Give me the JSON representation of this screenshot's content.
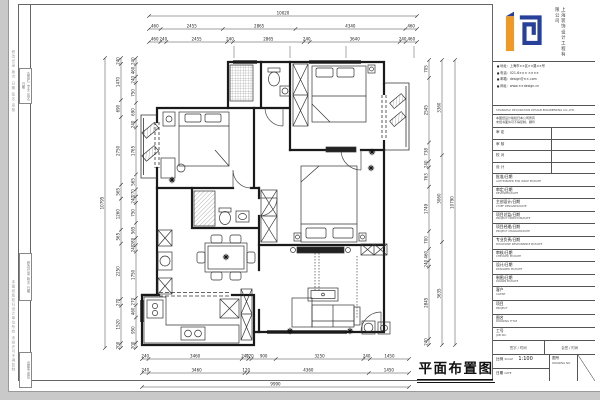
{
  "sheet": {
    "drawing_title": "平面布置图",
    "edge_note_top": "修改记录 版次 日期 签名 审核",
    "edge_note_bottom": "本图纸版权归设计单位所有 未经许可不得复制",
    "strip_boxes": [
      "会签栏 专业 签名 日期",
      "修改记录 版次 日期",
      "出图专用章"
    ]
  },
  "dims": {
    "top_overall": "10020",
    "top_row1": [
      "460",
      "2455",
      "2865",
      "4340",
      "460"
    ],
    "top_row2": [
      "460",
      "240",
      "2455",
      "240",
      "2865",
      "240",
      "3640",
      "240",
      "460"
    ],
    "bottom_row1": [
      "240",
      "3460",
      "240",
      "120",
      "900",
      "3250",
      "240",
      "1450"
    ],
    "bottom_row2": [
      "240",
      "3460",
      "120",
      "4360",
      "1450"
    ],
    "bottom_overall": "9990",
    "left_inner": [
      "240",
      "460",
      "240",
      "750",
      "690",
      "240",
      "1765",
      "565",
      "270",
      "240",
      "750",
      "565",
      "280",
      "240",
      "1750",
      "270",
      "460",
      "950",
      "200"
    ],
    "left_outer": [
      "240",
      "1470",
      "690",
      "2750",
      "565",
      "1260",
      "565",
      "2250",
      "270",
      "1520",
      "200"
    ],
    "left_overall": "10795",
    "right_inner": [
      "705",
      "2545",
      "738",
      "240",
      "763",
      "1749",
      "700",
      "460",
      "240",
      "2845",
      "240"
    ],
    "right_mid": [
      "3360",
      "3060",
      "3635"
    ],
    "right_overall": "10790"
  },
  "titleblock": {
    "company_cn": "上海装饰设计工程有限公司",
    "company_en": "SHANGHAI DECORATION DESIGN ENGINEERING CO.,LTD.",
    "contacts": [
      "地址：上海市××区××路××号",
      "电话：021-6××× ××××",
      "邮箱：design@××.com",
      "网址：www.××design.cn"
    ],
    "note_line1": "本图纸设计版权归本公司所有",
    "note_line2": "未经书面许可不得复制、翻印",
    "review_rows": [
      "审 定",
      "审 核",
      "校 对",
      "设 计"
    ],
    "sign_rows": [
      {
        "cn": "批准/日期",
        "en": "AUTHORIZED FOR ISSUE BY/DATE"
      },
      {
        "cn": "审定/日期",
        "en": "REVIEWED/DATE"
      },
      {
        "cn": "主创设计/日期",
        "en": "CHIEF DESIGNER/DATE"
      },
      {
        "cn": "项目总监/日期",
        "en": "PROJECT DIRECTOR/DATE"
      },
      {
        "cn": "项目经理/日期",
        "en": "PROJECT MANAGER/DATE"
      },
      {
        "cn": "专业负责/日期",
        "en": "DISCIPLINE RESPONSIBLE BY/DATE"
      },
      {
        "cn": "审核/日期",
        "en": "CHECKED BY/DATE"
      },
      {
        "cn": "设计/日期",
        "en": "DESIGNED BY/DATE"
      },
      {
        "cn": "制图/日期",
        "en": "DRAWN BY/DATE"
      }
    ],
    "client_cn": "客户",
    "client_en": "CLIENT",
    "project_cn": "项目",
    "project_en": "PROJECT",
    "dtitle_cn": "图名",
    "dtitle_en": "DRAWING TITLE",
    "job_cn": "工号",
    "job_en": "JOB NO.",
    "sigcell_left": "签字 / 时间",
    "sigcell_right": "会签 / 时间",
    "scale_cn": "比例",
    "scale_en": "SCALE",
    "scale_value": "1:100",
    "date_cn": "日期",
    "date_en": "DATE",
    "dn_cn": "图号",
    "dn_en": "DRAWING NO.",
    "logo_orange": "#ef9a27",
    "logo_blue": "#27409a"
  }
}
